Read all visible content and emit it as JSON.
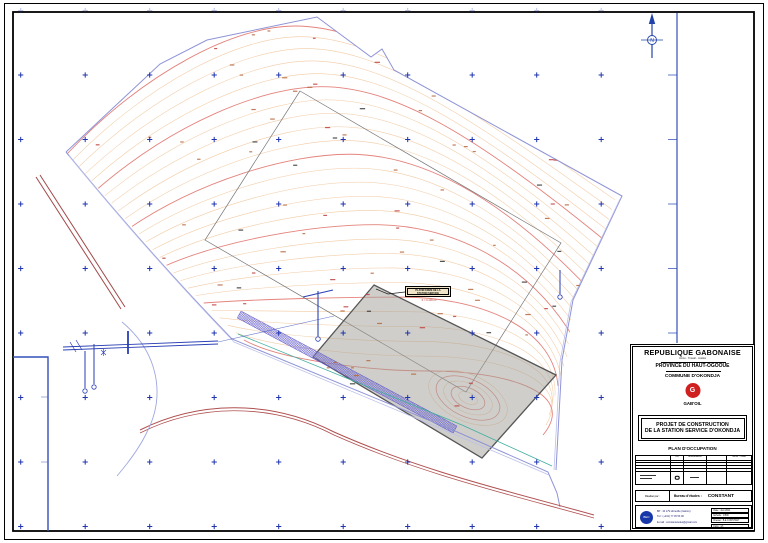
{
  "title_block": {
    "country": "REPUBLIQUE GABONAISE",
    "motto": "Union - Travail - Justice",
    "province": "PROVINCE DU HAUT-OGOOUE",
    "commune": "COMMUNE D'OKONDJA",
    "company": "GAB'OIL",
    "logo_letter": "G",
    "project_line1": "PROJET DE CONSTRUCTION",
    "project_line2": "DE LA STATION SERVICE D'OKONDJA",
    "drawing_title": "PLAN D'OCCUPATION",
    "table_headers": {
      "ind": "Ind",
      "modif": "Modifications",
      "visa": "Noms - Visas"
    },
    "made_by_label": "Réalisé par :",
    "office_label": "Bureau d'études :",
    "office_name": "CONSTANT",
    "contact_line1": "BP : 10 179 Libreville (Gabon)",
    "contact_line2": "Tél : (+241) 77 45 53 48",
    "contact_line3": "E-mail : constantetudes@gmail.com",
    "logo_small_text": "BEC",
    "meta_rows": [
      "Date : Juin 2021",
      "Echelle : 1/500",
      "Dressé : B.E CONSTANT",
      "Folio : 1/1"
    ]
  },
  "map": {
    "north_label": "N",
    "label_box": {
      "line1": "PLATEFORME DE LA",
      "line2": "STATION SERVICE",
      "sub": "S = 6.400 m²"
    },
    "grid": {
      "origin": [
        20.7,
        10.5
      ],
      "spacing": 64.5,
      "cols": 10,
      "rows": 9,
      "faint_first_row": true
    },
    "contours": {
      "count": 26,
      "major_every": 5,
      "loop_radii": [
        10,
        18,
        26,
        34,
        42
      ]
    },
    "specks": {
      "count": 70,
      "black_count": 14
    },
    "colors": {
      "cross": "#1e33b0",
      "contour_minor": "#f2cba4",
      "contour_major": "#e4837c",
      "boundary": "#8f94d6",
      "boundary_light": "#bcc0ea",
      "road_red": "#a24848",
      "teal": "#3fae9f",
      "hatch": "#6f68cf",
      "platform_fill": "rgba(160,158,150,0.5)",
      "platform_stroke": "#555555",
      "frame": "#000000",
      "margin_line": "#3350b8",
      "speck_brown": "#b5683f",
      "speck_red": "#c04040",
      "speck_black": "#333333"
    }
  }
}
